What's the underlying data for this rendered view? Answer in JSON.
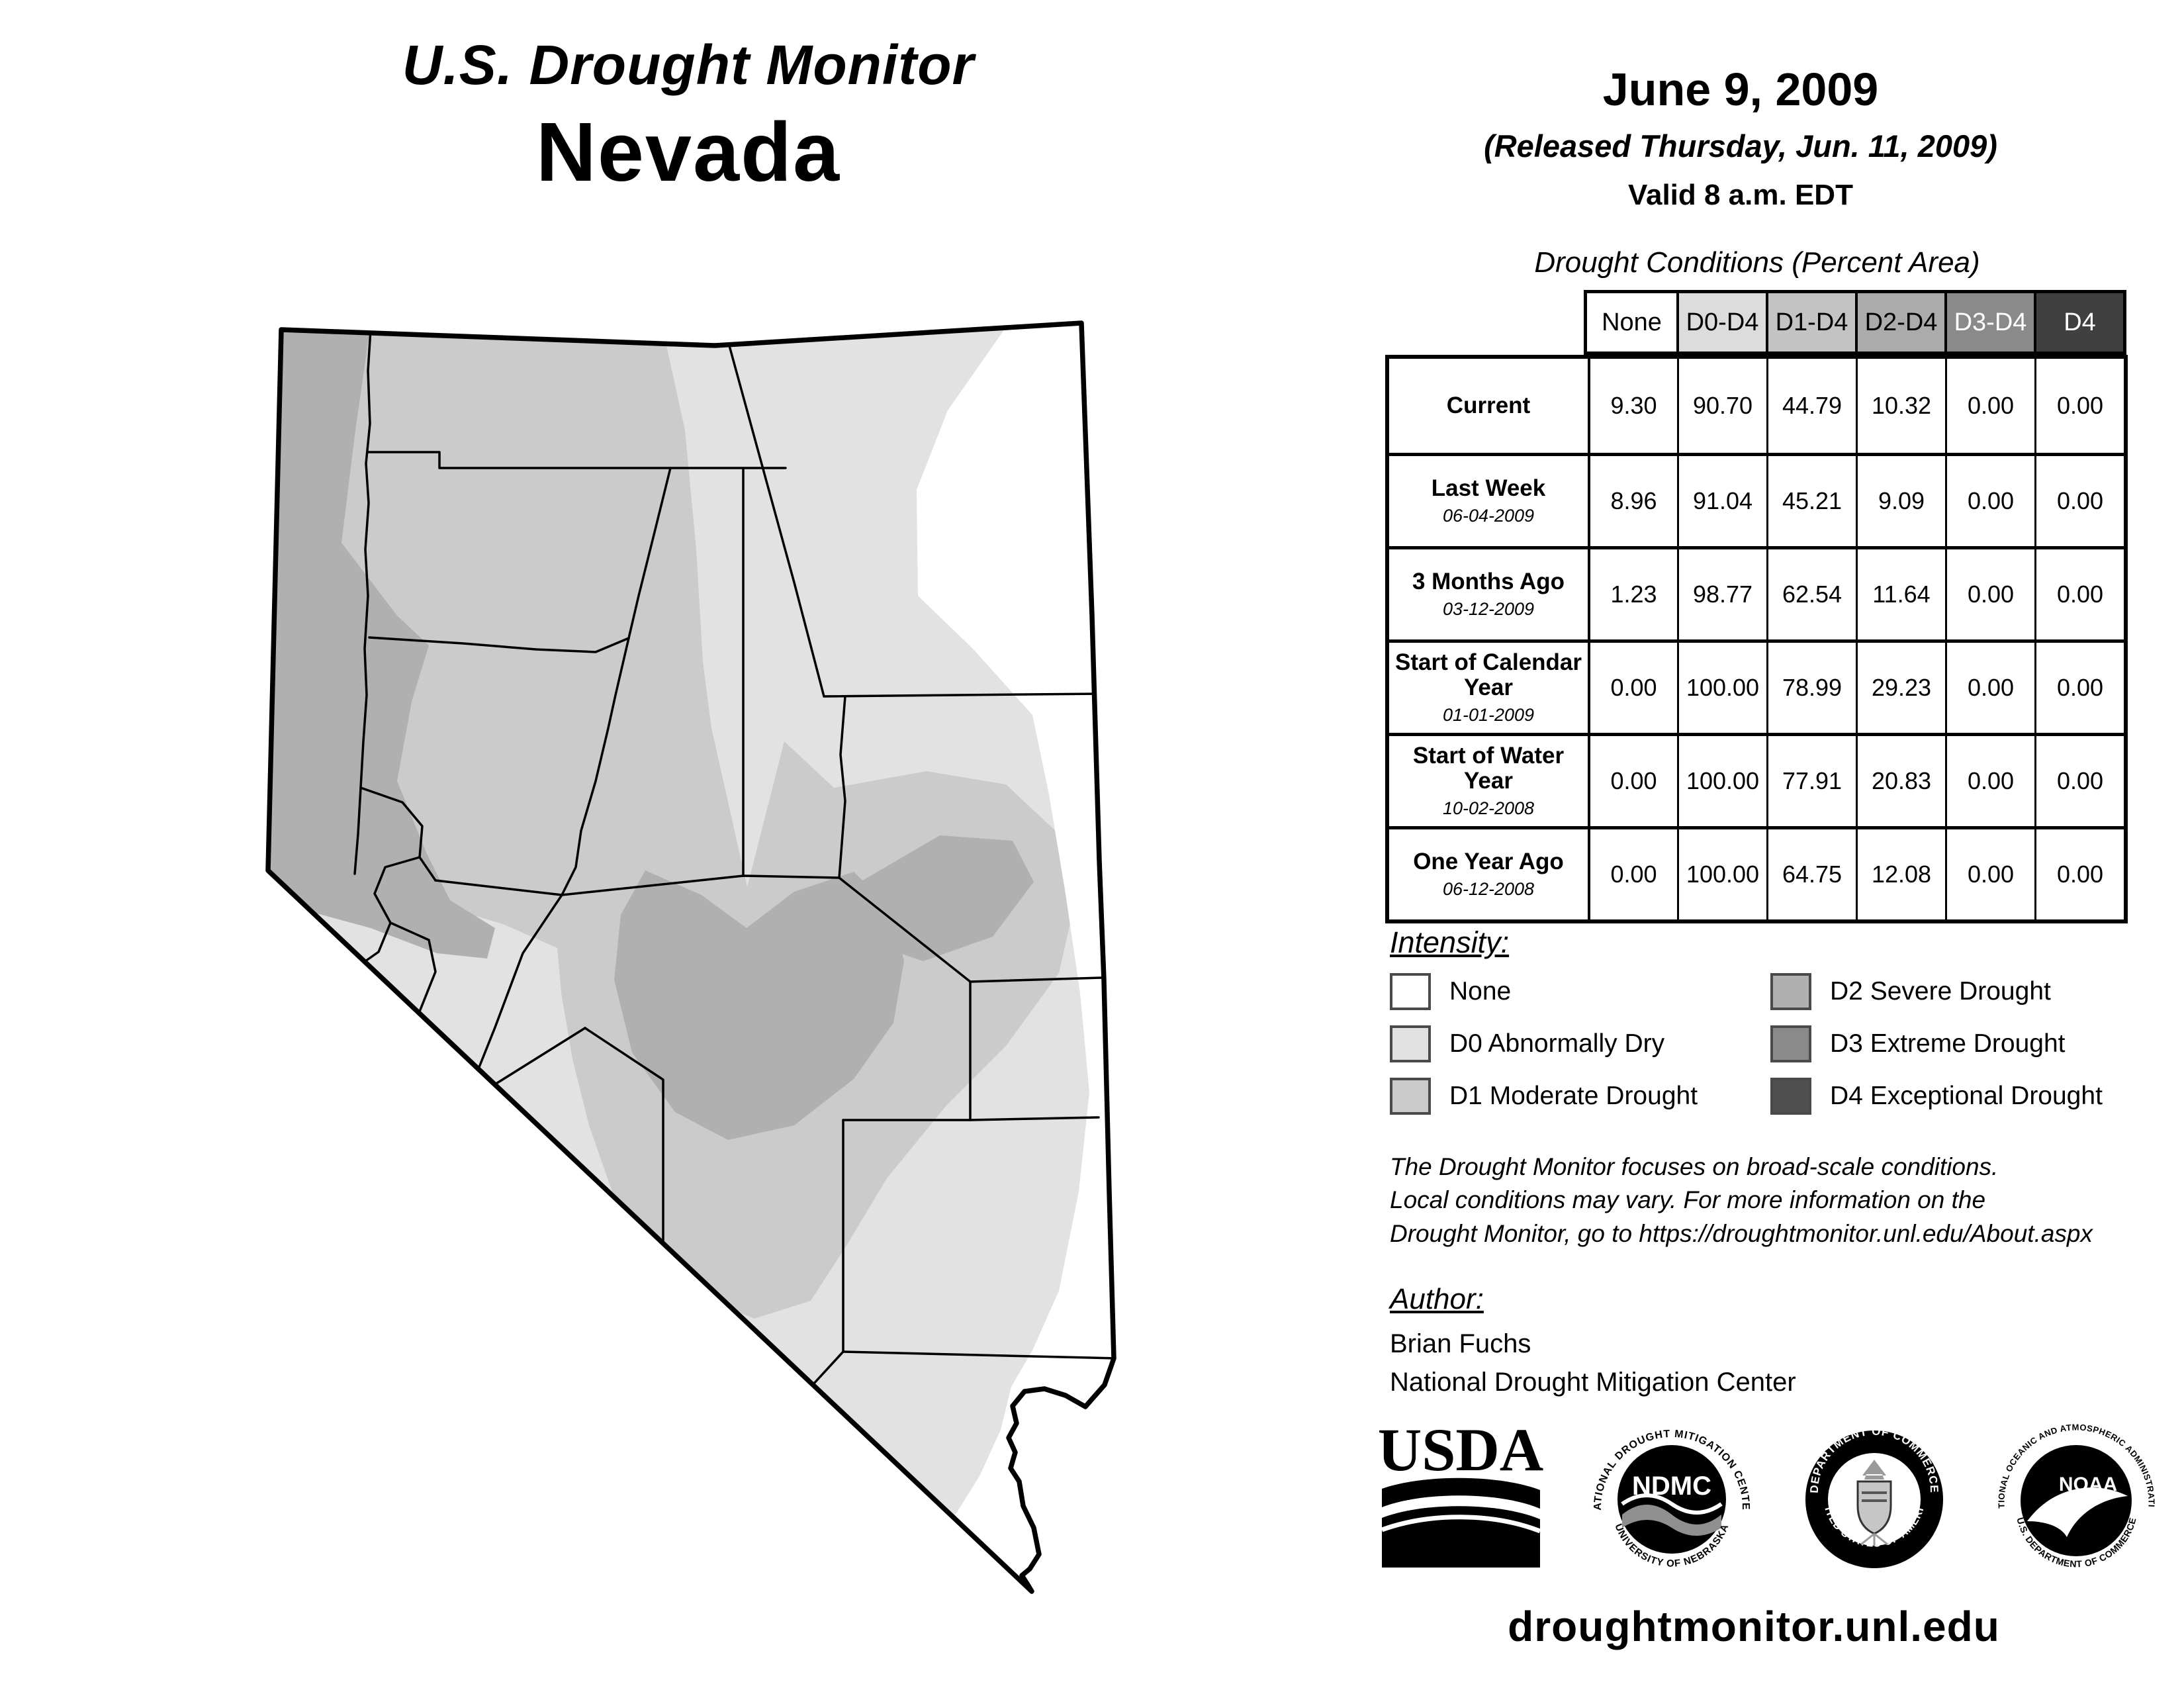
{
  "title": {
    "line1": "U.S. Drought Monitor",
    "line2": "Nevada"
  },
  "date": {
    "main": "June 9, 2009",
    "released": "(Released Thursday, Jun. 11, 2009)",
    "valid": "Valid 8 a.m. EDT"
  },
  "table": {
    "title": "Drought Conditions (Percent Area)",
    "columns": [
      "None",
      "D0-D4",
      "D1-D4",
      "D2-D4",
      "D3-D4",
      "D4"
    ],
    "header_bg": [
      "#ffffff",
      "#dcdcdc",
      "#c3c3c3",
      "#ababab",
      "#8a8a8a",
      "#404040"
    ],
    "header_fg": [
      "#000000",
      "#000000",
      "#000000",
      "#000000",
      "#ffffff",
      "#ffffff"
    ],
    "rows": [
      {
        "label": "Current",
        "sublabel": "",
        "values": [
          "9.30",
          "90.70",
          "44.79",
          "10.32",
          "0.00",
          "0.00"
        ]
      },
      {
        "label": "Last Week",
        "sublabel": "06-04-2009",
        "values": [
          "8.96",
          "91.04",
          "45.21",
          "9.09",
          "0.00",
          "0.00"
        ]
      },
      {
        "label": "3 Months Ago",
        "sublabel": "03-12-2009",
        "values": [
          "1.23",
          "98.77",
          "62.54",
          "11.64",
          "0.00",
          "0.00"
        ]
      },
      {
        "label": "Start of Calendar Year",
        "sublabel": "01-01-2009",
        "values": [
          "0.00",
          "100.00",
          "78.99",
          "29.23",
          "0.00",
          "0.00"
        ]
      },
      {
        "label": "Start of Water Year",
        "sublabel": "10-02-2008",
        "values": [
          "0.00",
          "100.00",
          "77.91",
          "20.83",
          "0.00",
          "0.00"
        ]
      },
      {
        "label": "One Year Ago",
        "sublabel": "06-12-2008",
        "values": [
          "0.00",
          "100.00",
          "64.75",
          "12.08",
          "0.00",
          "0.00"
        ]
      }
    ]
  },
  "legend": {
    "title": "Intensity:",
    "items": [
      {
        "label": "None",
        "color": "#ffffff"
      },
      {
        "label": "D0 Abnormally Dry",
        "color": "#e2e2e2"
      },
      {
        "label": "D1 Moderate Drought",
        "color": "#cbcbcb"
      },
      {
        "label": "D2 Severe Drought",
        "color": "#b0b0b0"
      },
      {
        "label": "D3 Extreme Drought",
        "color": "#8a8a8a"
      },
      {
        "label": "D4 Exceptional Drought",
        "color": "#4f4f4f"
      }
    ]
  },
  "colors": {
    "none": "#ffffff",
    "d0": "#e2e2e2",
    "d1": "#cbcbcb",
    "d2": "#b0b0b0"
  },
  "disclaimer": {
    "line1": "The Drought Monitor focuses on broad-scale conditions.",
    "line2": "Local conditions may vary. For more information on the",
    "line3": "Drought Monitor, go to https://droughtmonitor.unl.edu/About.aspx"
  },
  "author": {
    "title": "Author:",
    "name": "Brian Fuchs",
    "org": "National Drought Mitigation Center"
  },
  "logos": {
    "usda": {
      "text": "USDA"
    },
    "ndmc": {
      "ring_top": "NATIONAL DROUGHT MITIGATION CENTER",
      "center": "NDMC",
      "ring_bottom": "UNIVERSITY OF NEBRASKA"
    },
    "doc": {
      "ring_top": "DEPARTMENT OF COMMERCE",
      "ring_bottom": "UNITED STATES OF AMERICA"
    },
    "noaa": {
      "ring_top": "NATIONAL OCEANIC AND ATMOSPHERIC ADMINISTRATION",
      "center": "NOAA",
      "ring_bottom": "U.S. DEPARTMENT OF COMMERCE"
    }
  },
  "footer": {
    "url": "droughtmonitor.unl.edu"
  }
}
